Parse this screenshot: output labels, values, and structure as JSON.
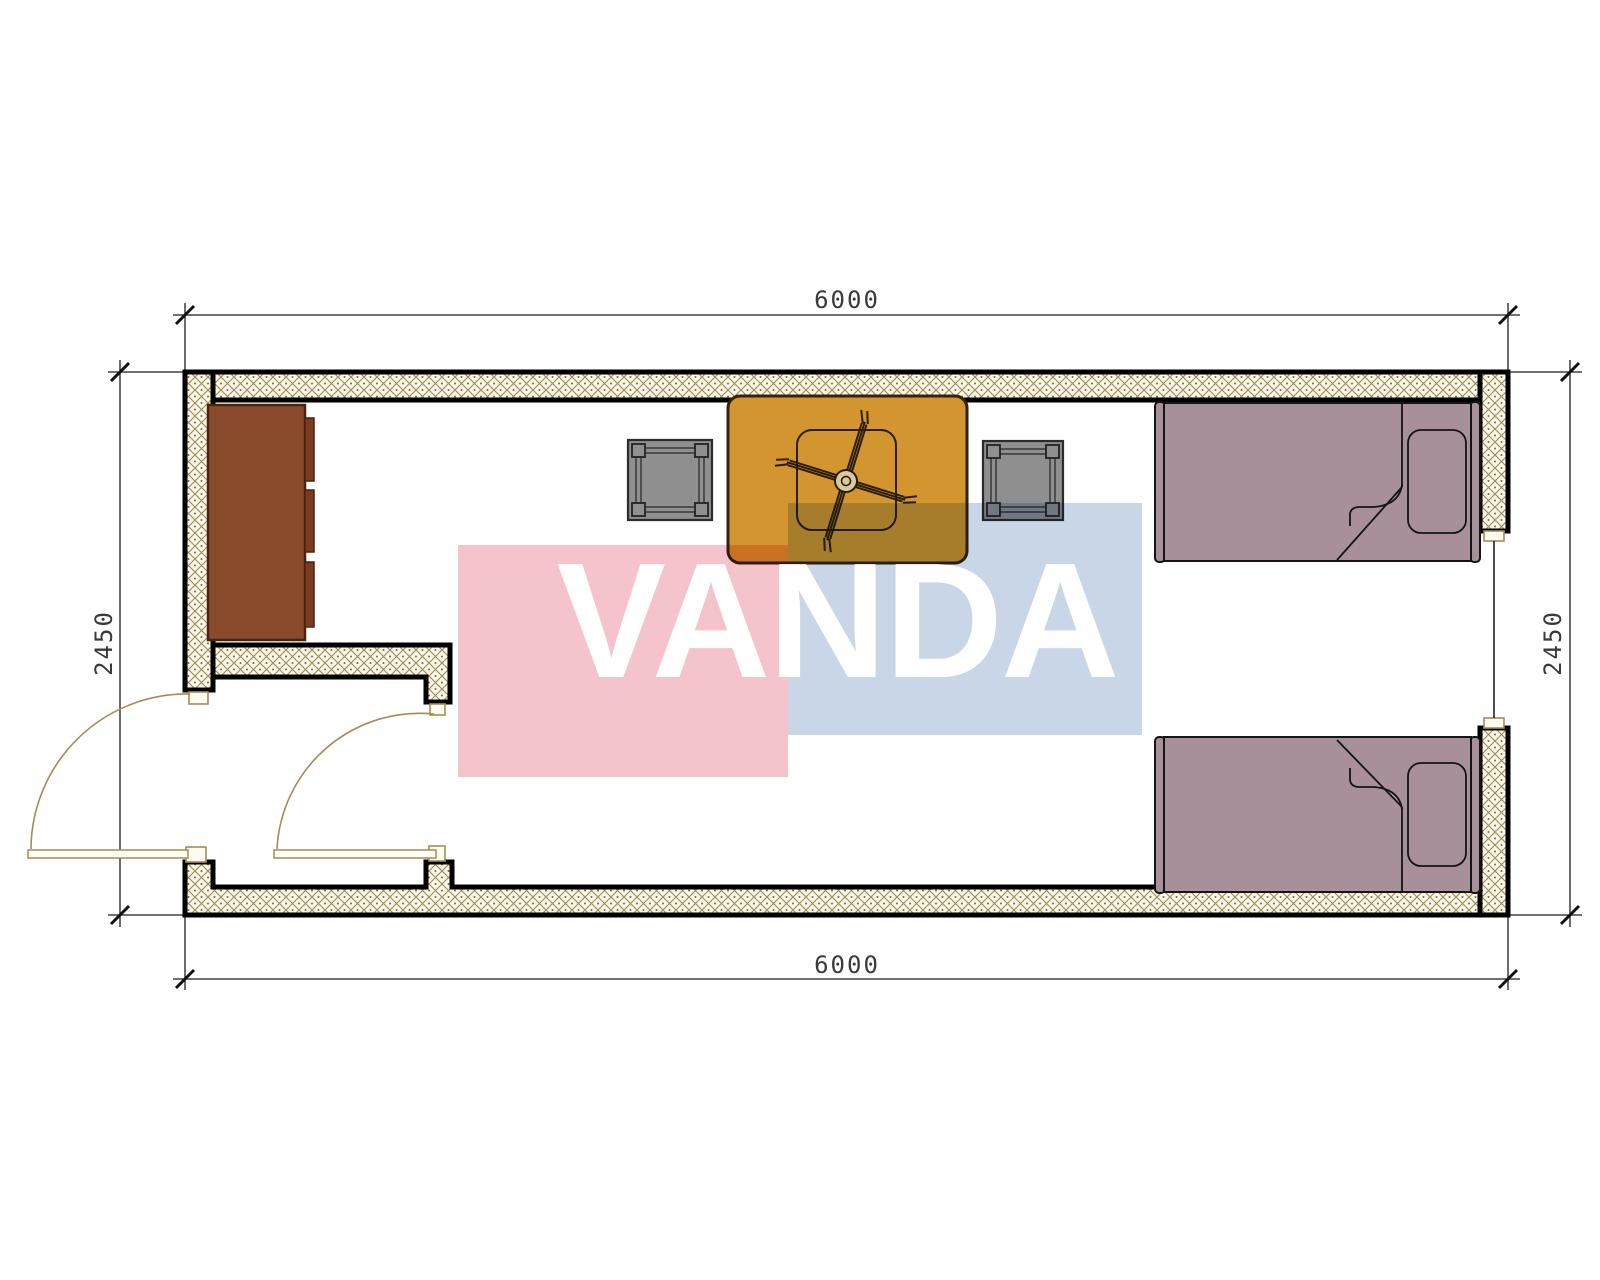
{
  "image_type": "architectural floor plan drawing",
  "dimensions": {
    "top": "6000",
    "bottom": "6000",
    "left": "2450",
    "right": "2450"
  },
  "watermark": {
    "text": "VANDA",
    "pink_block_color": "#f5c3cc",
    "blue_block_color": "#c9d6e8",
    "text_color": "#ffffff"
  },
  "colors": {
    "wall_hatch_line": "#9a8a57",
    "wall_hatch_background": "#fbf6e7",
    "wall_outline": "#000000",
    "dimension_line": "#1c1c1c",
    "door_symbol": "#a28d55",
    "cabinet": "#8a4a2c",
    "table": "#d2952f",
    "stool": "#8f8f8f",
    "bed": "#a8909a"
  },
  "plan_objects": {
    "wardrobe": "wardrobe-cabinet",
    "table": "square-dining-table",
    "fan": "ceiling-fan",
    "stool_left": "stool",
    "stool_right": "stool",
    "bed_top": "single-bed",
    "bed_bottom": "single-bed",
    "door_exterior": "entrance-door-swing",
    "door_interior": "interior-door-swing",
    "window": "window-opening"
  }
}
